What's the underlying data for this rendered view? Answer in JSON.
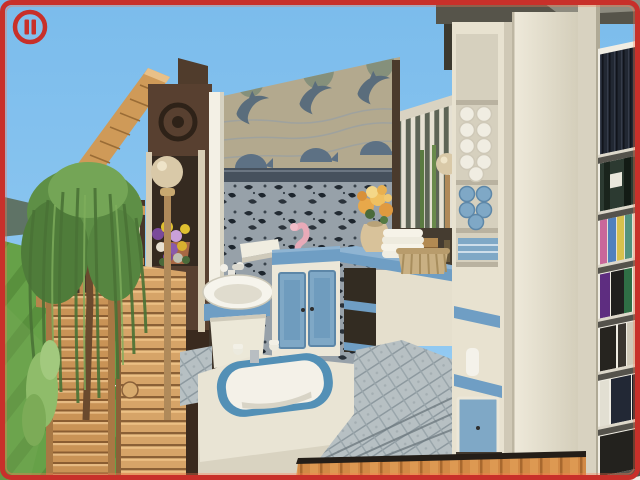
{
  "viewport": {
    "width": 640,
    "height": 480,
    "hud": {
      "pause_button": {
        "label": "Pause",
        "icon": "pause-icon"
      }
    }
  },
  "colors": {
    "border_red": "#c8302a",
    "sky": "#8cc5f0",
    "sky_top": "#7bbcec",
    "grass": "#66a148",
    "wood": "#cf9a58",
    "log_wood": "#d6a468",
    "dark_wood": "#4a3628",
    "wall_cream": "#e9e3d2",
    "accent_blue": "#6f9ec4",
    "towel_blue": "#7fa8c6",
    "tub_rim_blue": "#5390b6",
    "mural_beige": "#b3a98e",
    "mural_ink": "#5a6d7c",
    "wallpaper_slate": "#97a1a9",
    "tile": "#b7c0c3",
    "plank_wood": "#d28a46",
    "bookshelf_side": "#d8d2c0"
  },
  "scene": {
    "outdoor": {
      "sky": "clear blue sky",
      "hill": "distant hillside",
      "lawn": "green lawn with mowing stripes",
      "tree": "weeping willow tree",
      "shrub": "leafy green shrub",
      "upper_stairs": "upper wooden staircase edge",
      "deck_railing": "wooden deck railing",
      "staircase": "outdoor wooden staircase",
      "log_wall": "log cabin wall",
      "lamp": "globe lamp post",
      "flowers": "pansy flowers in planter",
      "emblem": "round wall emblem",
      "fence_wire": "thin wire fence"
    },
    "bathroom": {
      "mural": "dolphin wall mural",
      "wallpaper": "dark fish-print wallpaper",
      "column": "white support column",
      "window": "lattice slat window",
      "back_lamp": "small globe lamp",
      "niche": "dark storage niche with wooden box",
      "corner_shelf": "white corner shelf",
      "sink": "white pedestal basin sink",
      "sink_faucet": "white sink faucet",
      "figurine": "pink seahorse figurine",
      "vanity_cabinet": "blue double-door vanity cabinet",
      "open_shelf": "open shelf niche with blue shelves",
      "counter": "blue-top bathroom counter",
      "vase": "vase with orange flowers",
      "towel_stack": "stack of white towels",
      "basket": "wicker basket",
      "gold_accent": "small brass ornament",
      "bathtub": "white bathtub with blue rim",
      "tub_faucet": "chrome tub faucet",
      "floor": "blue mosaic tile floor",
      "towel_shelf": "white shelf tower with rolled towels",
      "lower_cabinet": "blue-door base cabinet",
      "front_pillar": "tall cream cabinet front",
      "roof_edge": "dark roof edge",
      "bookshelf": "tall bookshelf filled with books",
      "wood_floor_edge": "wooden plank floor edge"
    }
  }
}
